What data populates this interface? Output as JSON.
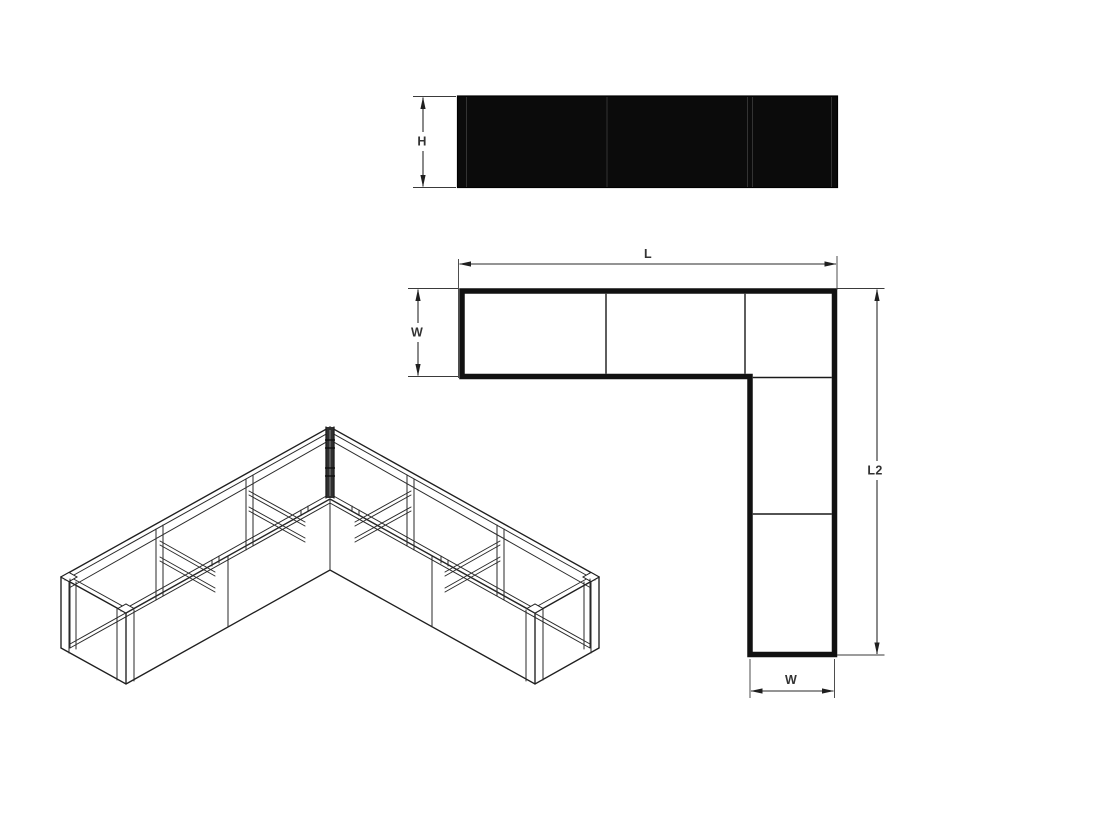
{
  "drawing": {
    "front_elevation": {
      "height_label": "H"
    },
    "plan_view": {
      "length_label": "L",
      "width_left_label": "W",
      "length2_label": "L2",
      "width_bottom_label": "W"
    },
    "colors": {
      "background": "#ffffff",
      "line": "#1f1f1f",
      "dimension_line": "#2a2a2a",
      "label_text": "#333333",
      "panel_fill": "#0b0b0b",
      "panel_seam": "#333333",
      "post_fill": "#2f2f2f"
    }
  }
}
